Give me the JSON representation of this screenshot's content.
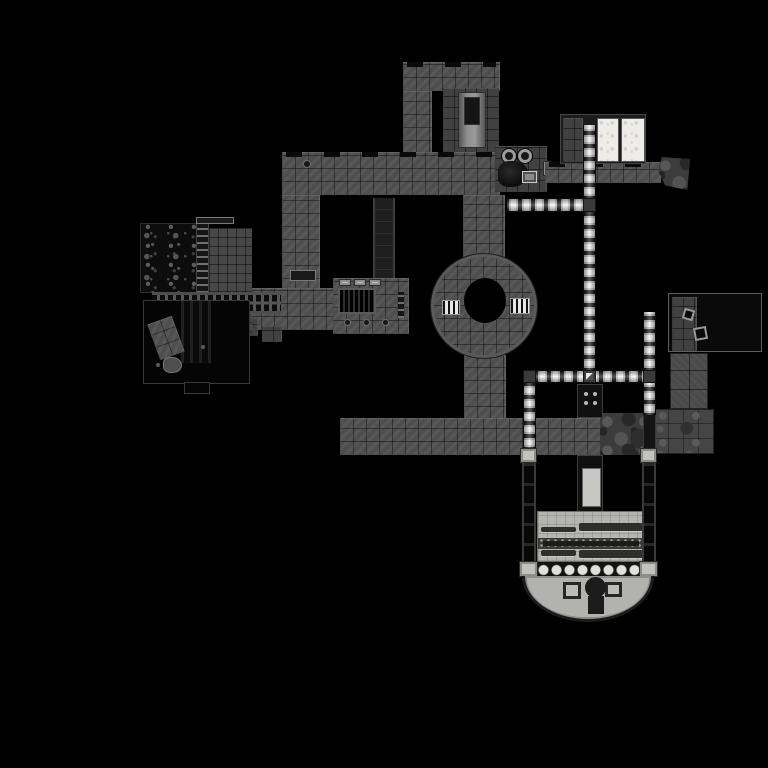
{
  "map": {
    "kind": "game-level-map",
    "canvas": {
      "width": 768,
      "height": 768
    },
    "palette": {
      "background": "#000000",
      "stone": "#4e4e4e",
      "stone_dark": "#414141",
      "void": "#0a0a0a",
      "lit_tile": "#f3f3f3",
      "floor_light": "#b4b4b0",
      "panel_white": "#edece8"
    },
    "regions": [
      {
        "name": "upper-block-top",
        "cls": "tile-gray edge-caps",
        "x": 403,
        "y": 62,
        "w": 97,
        "h": 29
      },
      {
        "name": "upper-block-west-corridor",
        "cls": "tile-gray",
        "x": 403,
        "y": 91,
        "w": 29,
        "h": 63
      },
      {
        "name": "upper-block-inner-room",
        "cls": "tile-gray2",
        "x": 443,
        "y": 88,
        "w": 56,
        "h": 64,
        "ch": [
          {
            "name": "elevator-shaft",
            "cls": "shaft-light",
            "x": 15,
            "y": 4,
            "w": 28,
            "h": 56,
            "ch": [
              {
                "name": "elevator-car",
                "cls": "dark-box",
                "x": 5,
                "y": 4,
                "w": 16,
                "h": 28
              }
            ]
          }
        ]
      },
      {
        "name": "main-corridor-west",
        "cls": "tile-gray edge-caps",
        "x": 282,
        "y": 152,
        "w": 218,
        "h": 43,
        "ch": [
          {
            "name": "floor-drain",
            "cls": "dot-dark",
            "x": 22,
            "y": 9,
            "w": 6,
            "h": 6
          }
        ]
      },
      {
        "name": "west-branch-corridor",
        "cls": "tile-gray",
        "x": 282,
        "y": 195,
        "w": 38,
        "h": 110,
        "ch": [
          {
            "name": "wall-slot",
            "cls": "slot-dark",
            "x": 8,
            "y": 75,
            "w": 26,
            "h": 11
          }
        ]
      },
      {
        "name": "dark-passage",
        "cls": "tile-dark",
        "x": 373,
        "y": 198,
        "w": 22,
        "h": 84
      },
      {
        "name": "link-corridor",
        "cls": "tile-gray",
        "x": 248,
        "y": 288,
        "w": 88,
        "h": 42
      },
      {
        "name": "stair-step-1",
        "cls": "tile-gray2",
        "x": 238,
        "y": 318,
        "w": 20,
        "h": 18
      },
      {
        "name": "stair-step-2",
        "cls": "tile-gray2",
        "x": 262,
        "y": 326,
        "w": 20,
        "h": 16
      },
      {
        "name": "grate-room",
        "cls": "tile-gray",
        "x": 333,
        "y": 278,
        "w": 76,
        "h": 56,
        "ch": [
          {
            "name": "floor-grate",
            "cls": "grate-v",
            "x": 5,
            "y": 10,
            "w": 38,
            "h": 26
          },
          {
            "name": "skylight-1",
            "cls": "cap-light",
            "x": 6,
            "y": 1,
            "w": 12,
            "h": 7
          },
          {
            "name": "skylight-2",
            "cls": "cap-light",
            "x": 21,
            "y": 1,
            "w": 12,
            "h": 7
          },
          {
            "name": "skylight-3",
            "cls": "cap-light",
            "x": 36,
            "y": 1,
            "w": 12,
            "h": 7
          },
          {
            "name": "floor-dot-1",
            "cls": "dot-dark",
            "x": 12,
            "y": 42,
            "w": 5,
            "h": 5
          },
          {
            "name": "floor-dot-2",
            "cls": "dot-dark",
            "x": 31,
            "y": 42,
            "w": 5,
            "h": 5
          },
          {
            "name": "floor-dot-3",
            "cls": "dot-dark",
            "x": 50,
            "y": 42,
            "w": 5,
            "h": 5
          },
          {
            "name": "side-ladder",
            "cls": "ladder",
            "x": 64,
            "y": 14,
            "w": 8,
            "h": 26
          }
        ]
      },
      {
        "name": "cave-room",
        "cls": "mottle",
        "x": 140,
        "y": 223,
        "w": 57,
        "h": 70
      },
      {
        "name": "ladder-shaft",
        "cls": "ladder",
        "x": 196,
        "y": 223,
        "w": 13,
        "h": 70
      },
      {
        "name": "store-room",
        "cls": "tile-gray3",
        "x": 209,
        "y": 228,
        "w": 43,
        "h": 64
      },
      {
        "name": "roof-vent",
        "cls": "slot-dark",
        "x": 196,
        "y": 217,
        "w": 38,
        "h": 7
      },
      {
        "name": "track-band",
        "cls": "track",
        "x": 152,
        "y": 292,
        "w": 129,
        "h": 22
      },
      {
        "name": "under-track-tiles",
        "cls": "tile-gray3",
        "x": 209,
        "y": 314,
        "w": 43,
        "h": 18
      },
      {
        "name": "pit-room",
        "cls": "black-room",
        "x": 143,
        "y": 300,
        "w": 107,
        "h": 84,
        "ch": [
          {
            "name": "pit-shaft",
            "cls": "stripes-v",
            "x": 37,
            "y": 0,
            "w": 30,
            "h": 62
          },
          {
            "name": "fallen-platform",
            "cls": "tile-gray",
            "x": 9,
            "y": 18,
            "w": 26,
            "h": 38,
            "rot": -20
          },
          {
            "name": "debris-pile",
            "cls": "blob",
            "x": 19,
            "y": 56,
            "w": 19,
            "h": 16
          },
          {
            "name": "speck-1",
            "cls": "dot-gray",
            "x": 57,
            "y": 44,
            "w": 4,
            "h": 4
          },
          {
            "name": "speck-2",
            "cls": "dot-gray",
            "x": 12,
            "y": 62,
            "w": 4,
            "h": 4
          }
        ]
      },
      {
        "name": "pit-room-annex",
        "cls": "black-room",
        "x": 184,
        "y": 382,
        "w": 26,
        "h": 12
      },
      {
        "name": "rotunda-north-corridor",
        "cls": "tile-gray",
        "x": 463,
        "y": 195,
        "w": 42,
        "h": 62
      },
      {
        "name": "rotunda-south-corridor",
        "cls": "tile-gray",
        "x": 464,
        "y": 355,
        "w": 42,
        "h": 65
      },
      {
        "name": "rotunda",
        "cls": "tile-gray rotunda",
        "x": 431,
        "y": 254,
        "w": 106,
        "h": 104,
        "ch": [
          {
            "name": "rotunda-hole",
            "cls": "hole",
            "x": 33,
            "y": 24,
            "w": 42,
            "h": 45
          },
          {
            "name": "rotunda-door-west",
            "cls": "door-grate",
            "x": 11,
            "y": 46,
            "w": 18,
            "h": 15
          },
          {
            "name": "rotunda-door-east",
            "cls": "door-grate",
            "x": 79,
            "y": 44,
            "w": 20,
            "h": 16
          }
        ]
      },
      {
        "name": "machine-room",
        "cls": "tile-gray2",
        "x": 495,
        "y": 146,
        "w": 52,
        "h": 46,
        "ch": [
          {
            "name": "machine-eye-left",
            "cls": "eye",
            "x": 7,
            "y": 3,
            "w": 14,
            "h": 14
          },
          {
            "name": "machine-eye-right",
            "cls": "eye",
            "x": 23,
            "y": 3,
            "w": 14,
            "h": 14
          },
          {
            "name": "machine-body",
            "cls": "blob-dark",
            "x": 3,
            "y": 15,
            "w": 30,
            "h": 26
          },
          {
            "name": "supply-crate",
            "cls": "crate",
            "x": 27,
            "y": 25,
            "w": 15,
            "h": 12
          }
        ]
      },
      {
        "name": "machine-room-door",
        "cls": "cap-light",
        "x": 543,
        "y": 161,
        "w": 8,
        "h": 15
      },
      {
        "name": "east-corridor",
        "cls": "tile-gray edge-caps",
        "x": 545,
        "y": 162,
        "w": 116,
        "h": 21
      },
      {
        "name": "rubble-wedge",
        "cls": "rock wedge",
        "x": 658,
        "y": 157,
        "w": 32,
        "h": 33
      },
      {
        "name": "main-corridor-south",
        "cls": "tile-gray",
        "x": 340,
        "y": 418,
        "w": 276,
        "h": 37
      },
      {
        "name": "south-corridor-rocks",
        "cls": "rock",
        "x": 600,
        "y": 413,
        "w": 45,
        "h": 42
      },
      {
        "name": "east-room-upper",
        "cls": "tile-gray4",
        "x": 670,
        "y": 353,
        "w": 38,
        "h": 56
      },
      {
        "name": "east-room-lower",
        "cls": "rock2",
        "x": 653,
        "y": 409,
        "w": 61,
        "h": 45
      },
      {
        "name": "bright-room",
        "cls": "dark-frame",
        "x": 560,
        "y": 114,
        "w": 86,
        "h": 50,
        "ch": [
          {
            "name": "bright-room-tiles",
            "cls": "tile-gray2",
            "x": 2,
            "y": 3,
            "w": 20,
            "h": 44
          },
          {
            "name": "bright-panel-west",
            "cls": "panel-white",
            "x": 36,
            "y": 3,
            "w": 22,
            "h": 44
          },
          {
            "name": "bright-panel-east",
            "cls": "panel-white",
            "x": 60,
            "y": 3,
            "w": 24,
            "h": 44
          }
        ]
      },
      {
        "name": "void-room",
        "cls": "black-room2",
        "x": 668,
        "y": 293,
        "w": 94,
        "h": 59,
        "ch": [
          {
            "name": "void-room-tiles",
            "cls": "tile-gray2",
            "x": 3,
            "y": 3,
            "w": 25,
            "h": 54
          },
          {
            "name": "crate-frame-1",
            "cls": "frame-sq",
            "x": 14,
            "y": 15,
            "w": 11,
            "h": 11,
            "rot": 15
          },
          {
            "name": "crate-frame-2",
            "cls": "frame-sq",
            "x": 25,
            "y": 33,
            "w": 13,
            "h": 13,
            "rot": -10
          }
        ]
      },
      {
        "name": "lit-corridor-north-upper",
        "cls": "lit-v",
        "x": 583,
        "y": 125,
        "w": 13,
        "h": 73
      },
      {
        "name": "lit-corridor-west",
        "cls": "lit-h",
        "x": 507,
        "y": 198,
        "w": 77,
        "h": 14
      },
      {
        "name": "lit-junction-north",
        "cls": "junction",
        "x": 583,
        "y": 198,
        "w": 13,
        "h": 14
      },
      {
        "name": "lit-corridor-north-lower",
        "cls": "lit-v",
        "x": 583,
        "y": 212,
        "w": 13,
        "h": 158
      },
      {
        "name": "lit-corridor-cross",
        "cls": "lit-h",
        "x": 523,
        "y": 370,
        "w": 132,
        "h": 13
      },
      {
        "name": "lit-corner-west",
        "cls": "junction",
        "x": 523,
        "y": 370,
        "w": 13,
        "h": 13
      },
      {
        "name": "lit-junction-center",
        "cls": "junction diamond",
        "x": 583,
        "y": 370,
        "w": 13,
        "h": 13
      },
      {
        "name": "lit-junction-east",
        "cls": "junction",
        "x": 643,
        "y": 370,
        "w": 13,
        "h": 13
      },
      {
        "name": "lit-corridor-southwest",
        "cls": "lit-v",
        "x": 523,
        "y": 383,
        "w": 13,
        "h": 66
      },
      {
        "name": "lit-corridor-east-upper",
        "cls": "lit-v",
        "x": 643,
        "y": 312,
        "w": 13,
        "h": 58
      },
      {
        "name": "lit-corridor-east-mid",
        "cls": "lit-v",
        "x": 643,
        "y": 383,
        "w": 13,
        "h": 32
      },
      {
        "name": "lit-corridor-east-dark",
        "cls": "dark-seg",
        "x": 643,
        "y": 415,
        "w": 13,
        "h": 36
      },
      {
        "name": "vent-shaft",
        "cls": "dark-box2",
        "x": 577,
        "y": 384,
        "w": 26,
        "h": 34,
        "ch": [
          {
            "name": "vent-dot-1",
            "cls": "dot-light",
            "x": 6,
            "y": 7,
            "w": 4,
            "h": 4
          },
          {
            "name": "vent-dot-2",
            "cls": "dot-light",
            "x": 15,
            "y": 7,
            "w": 4,
            "h": 4
          },
          {
            "name": "vent-dot-3",
            "cls": "dot-light",
            "x": 6,
            "y": 16,
            "w": 4,
            "h": 4
          },
          {
            "name": "vent-dot-4",
            "cls": "dot-light",
            "x": 15,
            "y": 16,
            "w": 4,
            "h": 4
          }
        ]
      },
      {
        "name": "altar-shaft",
        "cls": "dark-box2",
        "x": 577,
        "y": 455,
        "w": 26,
        "h": 60,
        "ch": [
          {
            "name": "altar-panel",
            "cls": "panel-light",
            "x": 4,
            "y": 12,
            "w": 19,
            "h": 39
          }
        ]
      },
      {
        "name": "nave-floor",
        "cls": "floor-light",
        "x": 537,
        "y": 511,
        "w": 106,
        "h": 51,
        "ch": [
          {
            "name": "pew-ne",
            "cls": "pew",
            "x": 41,
            "y": 11,
            "w": 64,
            "h": 8
          },
          {
            "name": "pew-nw",
            "cls": "pew",
            "x": 3,
            "y": 15,
            "w": 35,
            "h": 5
          },
          {
            "name": "nave-aisle",
            "cls": "aisle",
            "x": 0,
            "y": 26,
            "w": 106,
            "h": 11,
            "ch": [
              {
                "name": "aisle-core",
                "cls": "dark-box3",
                "x": 5,
                "y": 3,
                "w": 96,
                "h": 5
              }
            ]
          },
          {
            "name": "pew-sw",
            "cls": "pew",
            "x": 3,
            "y": 38,
            "w": 35,
            "h": 6
          },
          {
            "name": "pew-se",
            "cls": "pew",
            "x": 41,
            "y": 38,
            "w": 64,
            "h": 8
          }
        ]
      },
      {
        "name": "arch-row",
        "cls": "arches",
        "x": 524,
        "y": 562,
        "w": 130,
        "h": 16
      },
      {
        "name": "pillar-west",
        "cls": "pillar",
        "x": 522,
        "y": 463,
        "w": 14,
        "h": 100
      },
      {
        "name": "pillar-east",
        "cls": "pillar",
        "x": 642,
        "y": 463,
        "w": 14,
        "h": 100
      },
      {
        "name": "pillar-cap-nw",
        "cls": "cap-light",
        "x": 520,
        "y": 448,
        "w": 17,
        "h": 15
      },
      {
        "name": "pillar-cap-ne",
        "cls": "cap-light",
        "x": 640,
        "y": 448,
        "w": 17,
        "h": 15
      },
      {
        "name": "pillar-cap-sw",
        "cls": "cap-light",
        "x": 519,
        "y": 561,
        "w": 19,
        "h": 16
      },
      {
        "name": "pillar-cap-se",
        "cls": "cap-light",
        "x": 639,
        "y": 561,
        "w": 19,
        "h": 16
      },
      {
        "name": "apse",
        "cls": "apse",
        "x": 522,
        "y": 576,
        "w": 132,
        "h": 46,
        "ch": [
          {
            "name": "apse-pad-west",
            "cls": "frame-sq2",
            "x": 38,
            "y": 6,
            "w": 18,
            "h": 17
          },
          {
            "name": "apse-pad-east",
            "cls": "frame-sq2",
            "x": 80,
            "y": 6,
            "w": 17,
            "h": 15
          },
          {
            "name": "pulpit",
            "cls": "circle-dark",
            "x": 60,
            "y": 1,
            "w": 21,
            "h": 21
          },
          {
            "name": "pulpit-stem",
            "cls": "dark-box3",
            "x": 63,
            "y": 20,
            "w": 16,
            "h": 18
          }
        ]
      }
    ]
  }
}
